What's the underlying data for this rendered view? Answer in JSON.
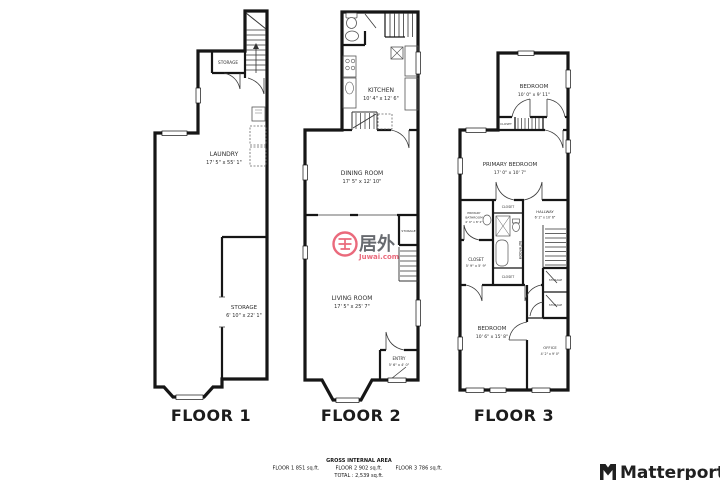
{
  "colors": {
    "wall": "#161616",
    "watermark_red": "#e8566b",
    "watermark_gray": "#53565c",
    "logo_dark": "#202020"
  },
  "floors": [
    {
      "label": "FLOOR 1",
      "rooms": {
        "storage_upper": {
          "name": "STORAGE"
        },
        "laundry": {
          "name": "LAUNDRY",
          "dims": "17' 5\" x 55' 1\""
        },
        "storage_lower": {
          "name": "STORAGE",
          "dims": "6' 10\" x 22' 1\""
        }
      }
    },
    {
      "label": "FLOOR 2",
      "rooms": {
        "kitchen": {
          "name": "KITCHEN",
          "dims": "10' 4\" x 12' 6\""
        },
        "dining": {
          "name": "DINING ROOM",
          "dims": "17' 5\" x 12' 10\""
        },
        "living": {
          "name": "LIVING ROOM",
          "dims": "17' 5\" x 25' 7\""
        },
        "entry": {
          "name": "ENTRY",
          "dims": "5' 6\" x 4' 0\""
        },
        "storage": {
          "name": "STORAGE"
        }
      }
    },
    {
      "label": "FLOOR 3",
      "rooms": {
        "bedroom_top": {
          "name": "BEDROOM",
          "dims": "10' 0\" x 9' 11\""
        },
        "closet_landing": {
          "name": "CLOSET"
        },
        "primary_bedroom": {
          "name": "PRIMARY BEDROOM",
          "dims": "17' 0\" x 10' 7\""
        },
        "primary_bathroom": {
          "line1": "PRIMARY",
          "line2": "BATHROOM",
          "dims": "4' 9\" x 8' 2\""
        },
        "closet_primary": {
          "name": "CLOSET",
          "dims": "5' 9\" x 5' 9\""
        },
        "closet_top": {
          "name": "CLOSET"
        },
        "bathroom": {
          "name": "BATHROOM"
        },
        "closet_bottom": {
          "name": "CLOSET"
        },
        "hallway": {
          "name": "HALLWAY",
          "dims": "6' 2\" x 10' 6\""
        },
        "storage_upper": {
          "name": "STORAGE"
        },
        "storage_lower": {
          "name": "STORAGE"
        },
        "bedroom": {
          "name": "BEDROOM",
          "dims": "10' 6\" x 15' 8\""
        },
        "office": {
          "name": "OFFICE",
          "dims": "4' 2\" x 9' 0\""
        }
      }
    }
  ],
  "footer": {
    "heading": "GROSS INTERNAL AREA",
    "floor1": "FLOOR 1 851 sq.ft.",
    "floor2": "FLOOR 2 902 sq.ft.",
    "floor3": "FLOOR 3 786 sq.ft.",
    "total": "TOTAL :  2,539 sq.ft."
  },
  "watermark": {
    "brand": "居外",
    "site": "Juwai.com"
  },
  "branding": {
    "name": "Matterport"
  }
}
